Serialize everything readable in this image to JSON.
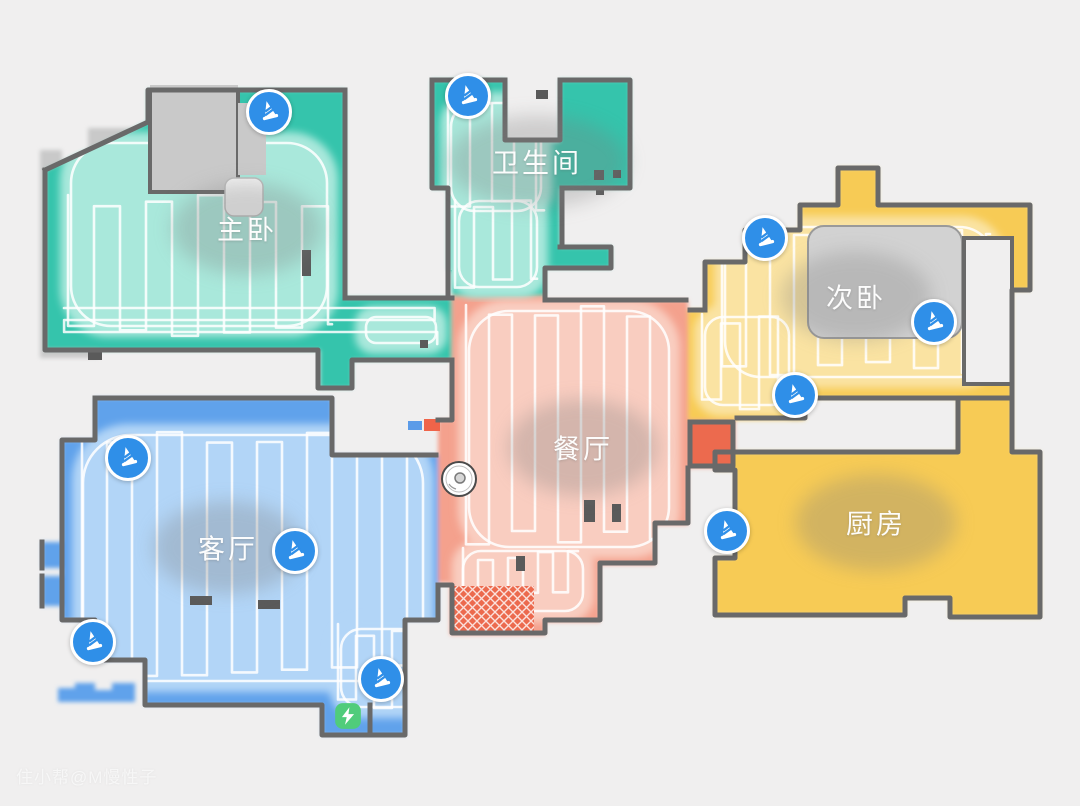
{
  "app": {
    "view": "robot-vacuum-cleaning-map"
  },
  "watermark": "住小帮@M慢性子",
  "colors": {
    "bg": "#f0efef",
    "wall": "#696969",
    "teal": "#35c4ac",
    "teal_light": "#a9e8db",
    "salmon": "#f4a18d",
    "salmon_light": "#f9cdc0",
    "salmon_deep": "#ec6a4e",
    "blue": "#60a2eb",
    "blue_light": "#b2d5f7",
    "yellow": "#f7cb55",
    "yellow_light": "#fae3a2",
    "gray_block": "#c9c9c9",
    "obstacle_gray": "#d2d2d2",
    "marker_blue": "#2f8fe8",
    "dock_green": "#50cc7b",
    "path_white": "rgba(255,255,255,0.85)"
  },
  "rooms": [
    {
      "id": "master_bedroom",
      "label": "主卧",
      "color_key": "teal",
      "label_pos": {
        "x": 247,
        "y": 228
      },
      "label_size": {
        "w": 150,
        "h": 92
      },
      "cleans": [
        [
          60,
          132,
          278,
          205,
          48
        ],
        [
          355,
          306,
          92,
          48,
          18
        ]
      ],
      "sweeps": [
        [
          68,
          195,
          264,
          142,
          26,
          "v"
        ],
        [
          64,
          308,
          386,
          36,
          12,
          "h"
        ]
      ]
    },
    {
      "id": "bathroom",
      "label": "卫生间",
      "color_key": "teal",
      "label_pos": {
        "x": 537,
        "y": 161
      },
      "label_size": {
        "w": 180,
        "h": 92
      },
      "cleans": [
        [
          440,
          92,
          112,
          130,
          32
        ],
        [
          448,
          190,
          100,
          108,
          28
        ]
      ],
      "sweeps": [
        [
          448,
          100,
          96,
          115,
          22,
          "v"
        ],
        [
          455,
          200,
          82,
          92,
          19,
          "v"
        ]
      ]
    },
    {
      "id": "dining_room",
      "label": "餐厅",
      "color_key": "salmon",
      "label_pos": {
        "x": 583,
        "y": 447
      },
      "label_size": {
        "w": 150,
        "h": 96
      },
      "cleans": [
        [
          458,
          300,
          222,
          258,
          48
        ],
        [
          452,
          540,
          142,
          82,
          26
        ]
      ],
      "sweeps": [
        [
          466,
          305,
          200,
          240,
          23,
          "v"
        ],
        [
          463,
          548,
          115,
          58,
          15,
          "v"
        ]
      ]
    },
    {
      "id": "second_bedroom",
      "label": "次卧",
      "color_key": "yellow",
      "label_pos": {
        "x": 856,
        "y": 296
      },
      "label_size": {
        "w": 150,
        "h": 90
      },
      "cleans": [
        [
          714,
          216,
          292,
          172,
          44
        ],
        [
          694,
          306,
          106,
          110,
          26
        ]
      ],
      "sweeps": [
        [
          722,
          224,
          268,
          152,
          24,
          "v"
        ],
        [
          702,
          314,
          88,
          96,
          19,
          "v"
        ]
      ]
    },
    {
      "id": "kitchen",
      "label": "厨房",
      "color_key": "yellow",
      "label_pos": {
        "x": 876,
        "y": 522
      },
      "label_size": {
        "w": 160,
        "h": 96
      },
      "cleans": [],
      "sweeps": []
    },
    {
      "id": "living_room",
      "label": "客厅",
      "color_key": "blue",
      "label_pos": {
        "x": 228,
        "y": 547
      },
      "label_size": {
        "w": 150,
        "h": 92
      },
      "cleans": [
        [
          72,
          424,
          362,
          268,
          56
        ],
        [
          330,
          618,
          102,
          100,
          28
        ]
      ],
      "sweeps": [
        [
          82,
          432,
          340,
          245,
          25,
          "v"
        ],
        [
          338,
          624,
          86,
          88,
          18,
          "v"
        ]
      ]
    }
  ],
  "markers": {
    "icon": "traffic-cone",
    "items": [
      {
        "x": 269,
        "y": 112
      },
      {
        "x": 468,
        "y": 96
      },
      {
        "x": 765,
        "y": 238
      },
      {
        "x": 934,
        "y": 322
      },
      {
        "x": 795,
        "y": 395
      },
      {
        "x": 128,
        "y": 458
      },
      {
        "x": 295,
        "y": 551
      },
      {
        "x": 727,
        "y": 531
      },
      {
        "x": 93,
        "y": 642
      },
      {
        "x": 381,
        "y": 679
      }
    ]
  },
  "robot": {
    "x": 459,
    "y": 479
  },
  "dock": {
    "x": 348,
    "y": 716
  }
}
